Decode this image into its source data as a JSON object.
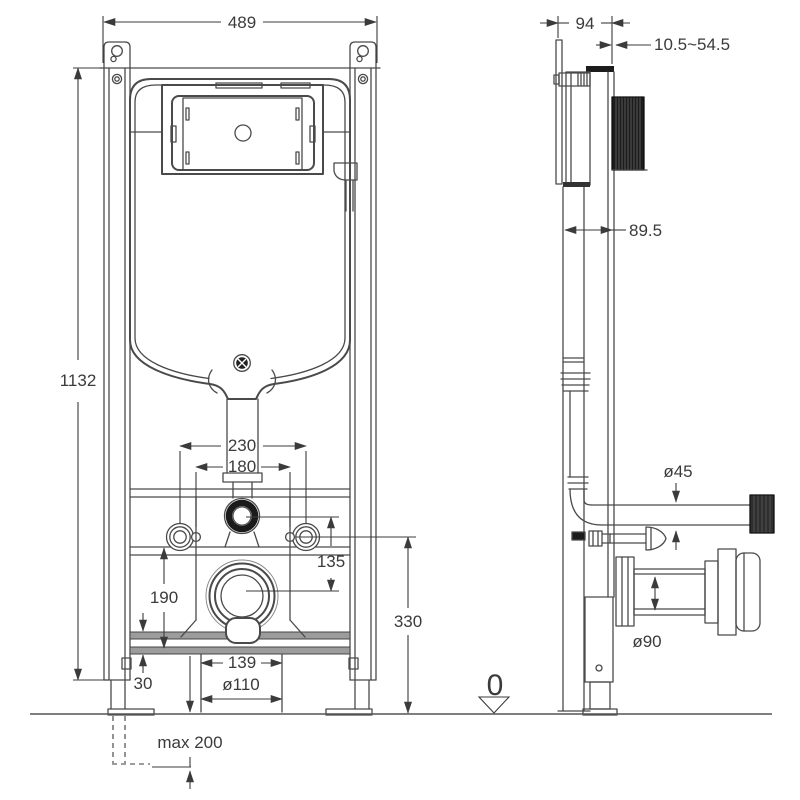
{
  "dims": {
    "front": {
      "overall_width": "489",
      "overall_height": "1132",
      "fixing_bolt_spacing": "230",
      "inner_fixing_spacing": "180",
      "flush_to_waste_offset": "135",
      "lower_bracket_height": "190",
      "fixing_height_above_floor": "330",
      "outlet_bracket_width": "139",
      "rail_end_offset": "30",
      "waste_pipe_diameter": "ø110",
      "max_leg_extension": "max 200"
    },
    "side": {
      "overall_depth": "94",
      "wall_adjustment_range": "10.5~54.5",
      "frame_depth": "89.5",
      "flush_pipe_diameter": "ø45",
      "waste_connector_diameter": "ø90"
    },
    "datum": {
      "floor_level": "0"
    }
  }
}
